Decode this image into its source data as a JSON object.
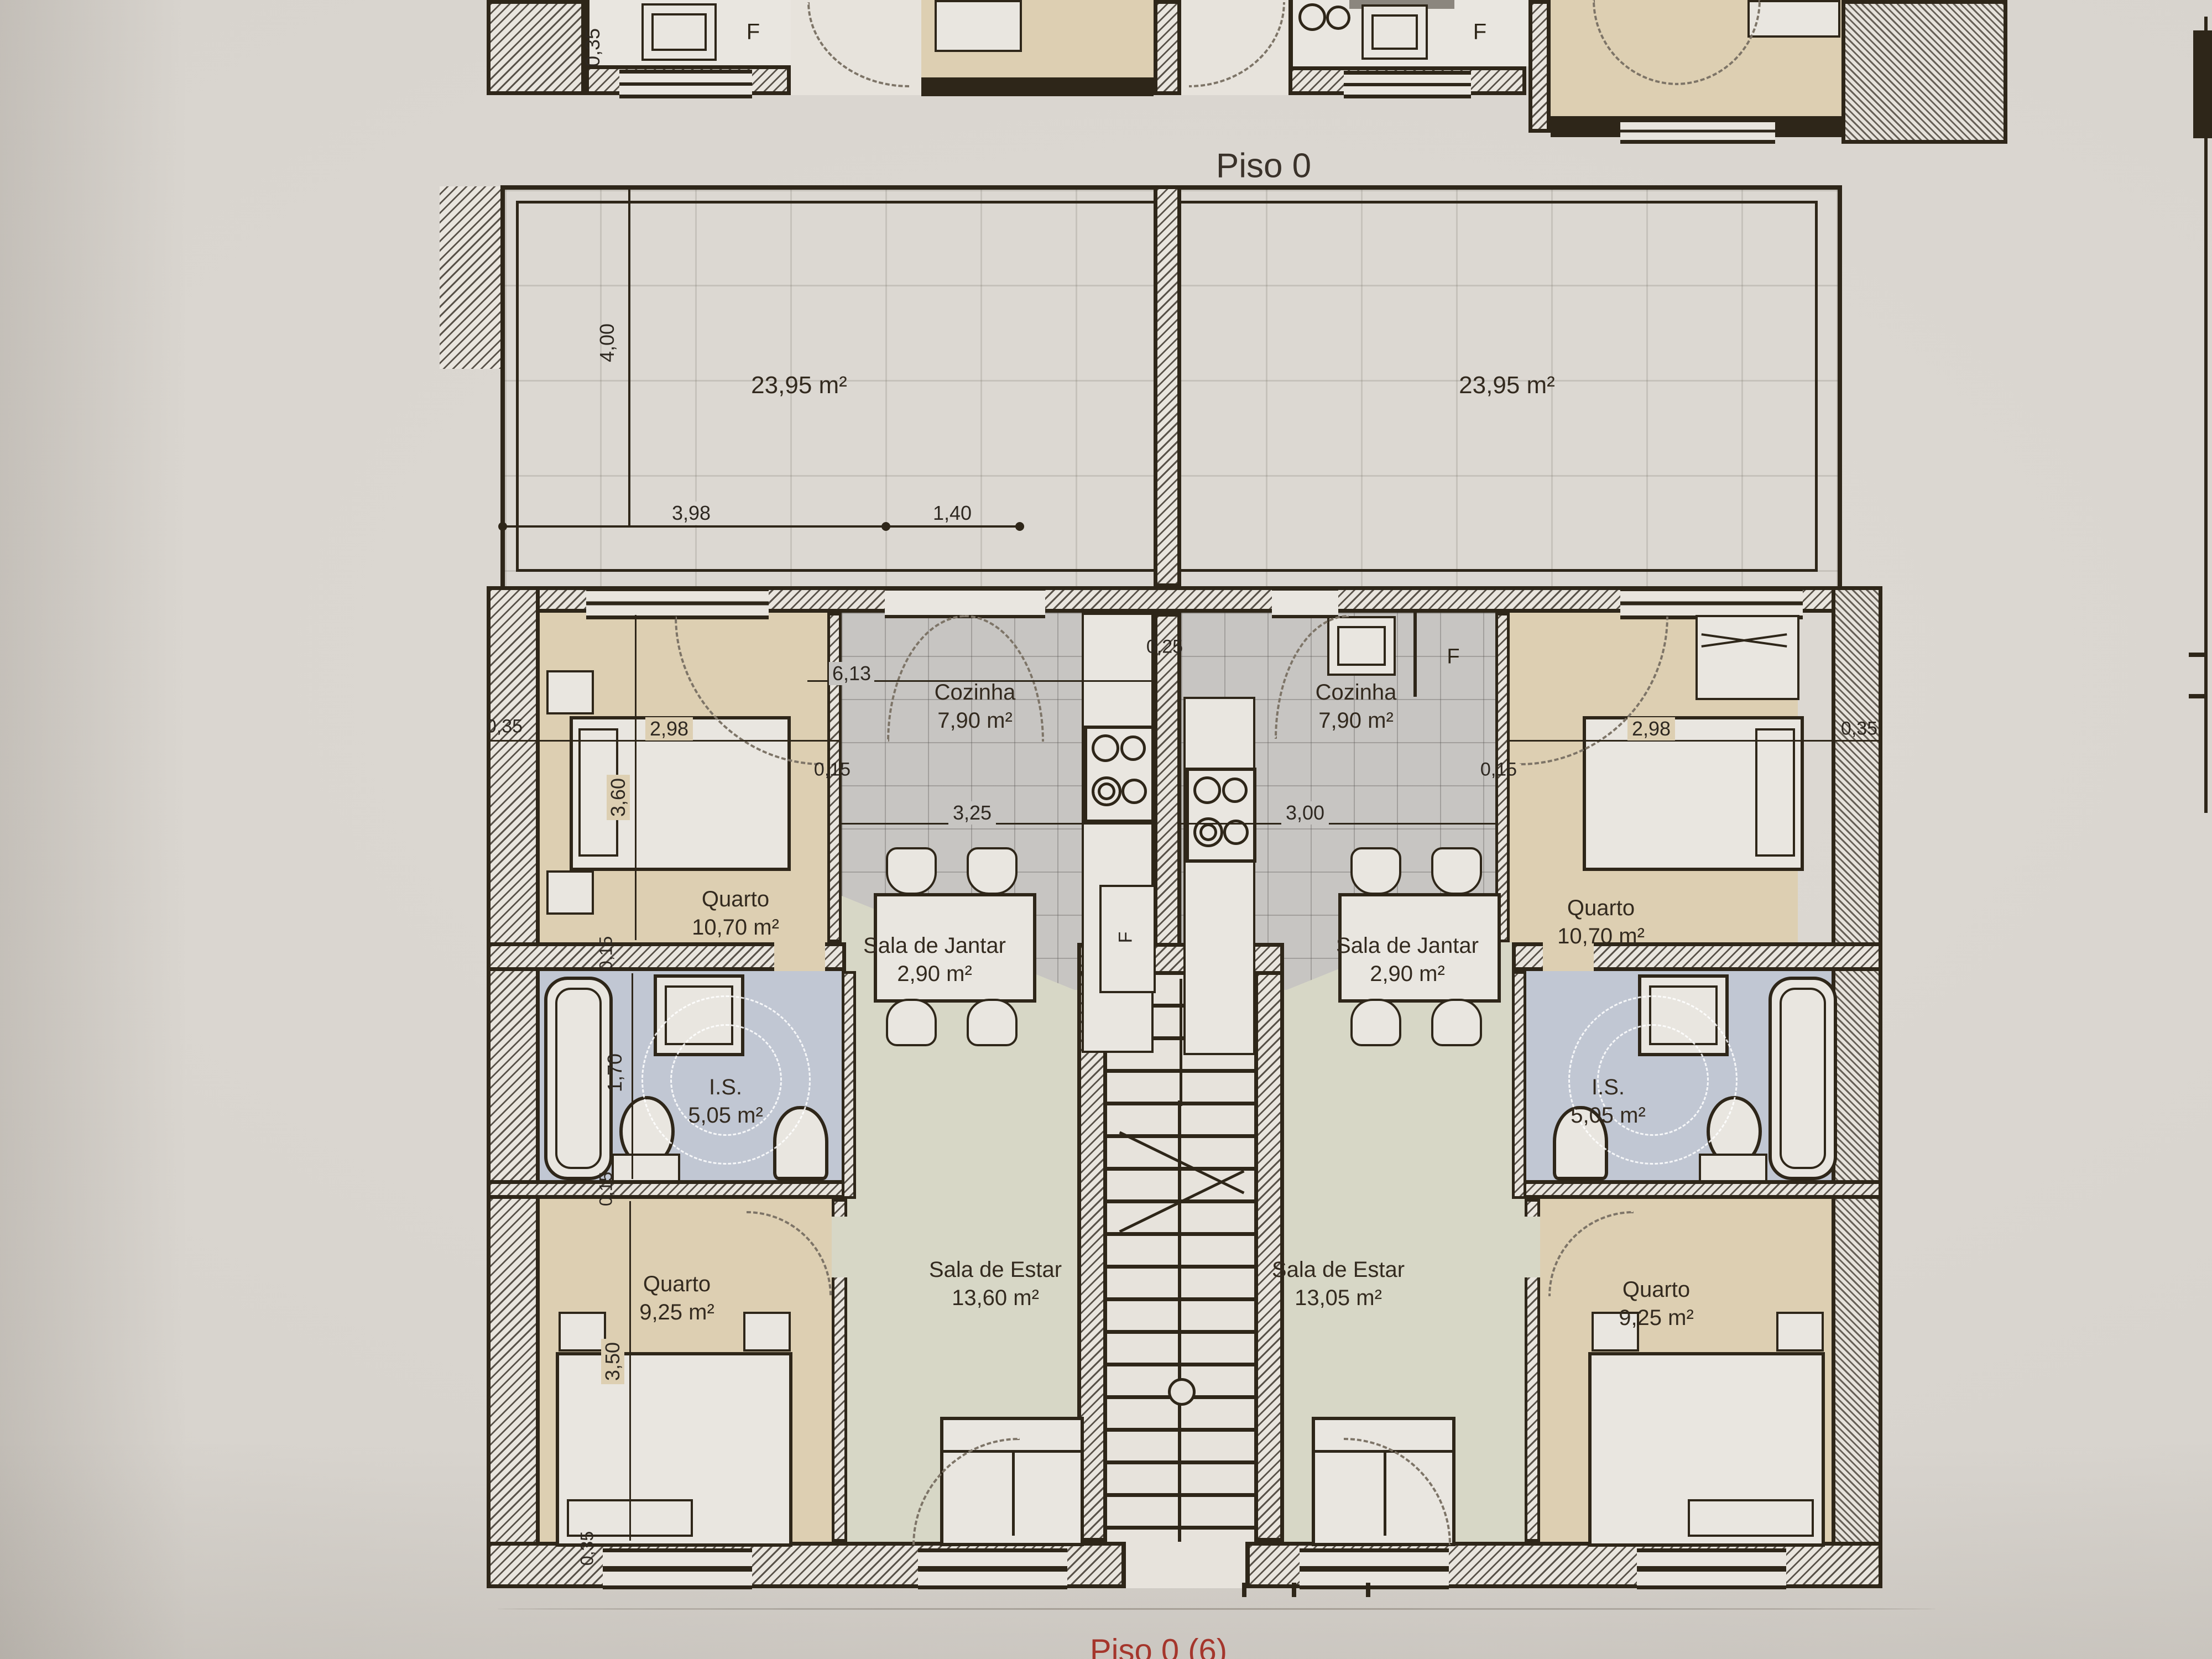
{
  "plan": {
    "title": "Piso 0",
    "footer": "Piso 0 (6)",
    "fridge": "F"
  },
  "terraces": [
    {
      "area": "23,95 m²"
    },
    {
      "area": "23,95 m²"
    }
  ],
  "rooms": [
    {
      "name": "Quarto",
      "area": "10,70 m²",
      "unit": "left"
    },
    {
      "name": "Cozinha",
      "area": "7,90 m²",
      "unit": "left"
    },
    {
      "name": "Sala de Jantar",
      "area": "2,90 m²",
      "unit": "left"
    },
    {
      "name": "I.S.",
      "area": "5,05 m²",
      "unit": "left"
    },
    {
      "name": "Quarto",
      "area": "9,25 m²",
      "unit": "left"
    },
    {
      "name": "Sala de Estar",
      "area": "13,60 m²",
      "unit": "left"
    },
    {
      "name": "Cozinha",
      "area": "7,90 m²",
      "unit": "right"
    },
    {
      "name": "Quarto",
      "area": "10,70 m²",
      "unit": "right"
    },
    {
      "name": "Sala de Jantar",
      "area": "2,90 m²",
      "unit": "right"
    },
    {
      "name": "Sala de Estar",
      "area": "13,05 m²",
      "unit": "right"
    },
    {
      "name": "I.S.",
      "area": "5,05 m²",
      "unit": "right"
    },
    {
      "name": "Quarto",
      "area": "9,25 m²",
      "unit": "right"
    }
  ],
  "dimensions": {
    "terrace_height": "4,00",
    "terrace_width_a": "3,98",
    "terrace_width_b": "1,40",
    "kitchen_top": "6,13",
    "center_half_wall": "0,25",
    "kitchen_width_left": "3,25",
    "kitchen_width_right": "3,00",
    "outer_wall_left": "0,35",
    "bedroom_width_left": "2,98",
    "partition_left": "0,15",
    "partition_right": "0,15",
    "bedroom_width_right": "2,98",
    "outer_wall_right": "0,35",
    "bedroom_height_left": "3,60",
    "bath_wall_top": "0,15",
    "bath_height": "1,70",
    "bath_wall_bottom": "0,15",
    "bedroom2_height": "3,50",
    "bottom_wall": "0,35",
    "upper_strip_wall": "0,35"
  },
  "colors": {
    "paper": "#d8d4ce",
    "ink": "#2e2619",
    "bedroom_floor": "#ddcfb2",
    "kitchen_floor": "#c7c5c2",
    "living_floor": "#d7d7c6",
    "bath_floor": "#c1c7d3",
    "footer_red": "#a5362c"
  }
}
